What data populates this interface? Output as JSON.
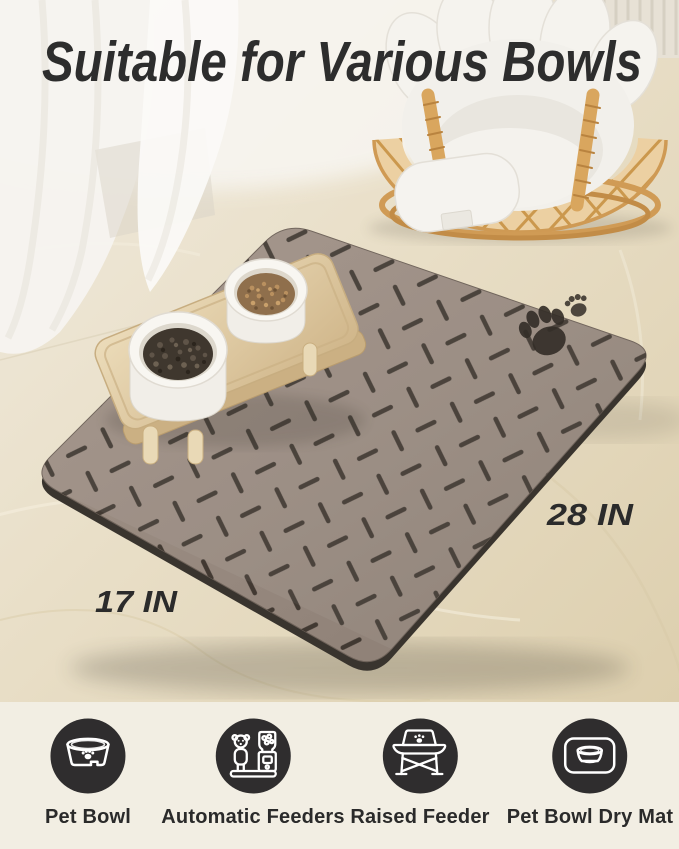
{
  "title": {
    "text": "Suitable for Various Bowls"
  },
  "photo": {
    "labels": {
      "width": "28 IN",
      "depth": "17 IN"
    },
    "scene": {
      "mat_color": "#96887e",
      "mat_pattern_color": "#39312a",
      "mat_edge_color": "#39342e",
      "floor_color": "#e9dfc8",
      "wood_stand_color": "#dcc69e",
      "rattan_color": "#d39e58",
      "cushion_color": "#f3f1ed",
      "kibble_dark_color": "#3f372e",
      "kibble_light_color": "#8f6f4c"
    }
  },
  "features": [
    {
      "icon": "pet-bowl-icon",
      "label": "Pet Bowl"
    },
    {
      "icon": "automatic-feeder-icon",
      "label": "Automatic Feeders"
    },
    {
      "icon": "raised-feeder-icon",
      "label": "Raised Feeder"
    },
    {
      "icon": "pet-bowl-dry-mat-icon",
      "label": "Pet Bowl Dry Mat"
    }
  ],
  "colors": {
    "title_text": "#2d2d2d",
    "dimension_text": "#2b2b2b",
    "feature_label_text": "#2a2a2a",
    "icon_circle": "#2f2d2e",
    "icon_glyph": "#ffffff",
    "footer_background": "#f2eee3"
  }
}
